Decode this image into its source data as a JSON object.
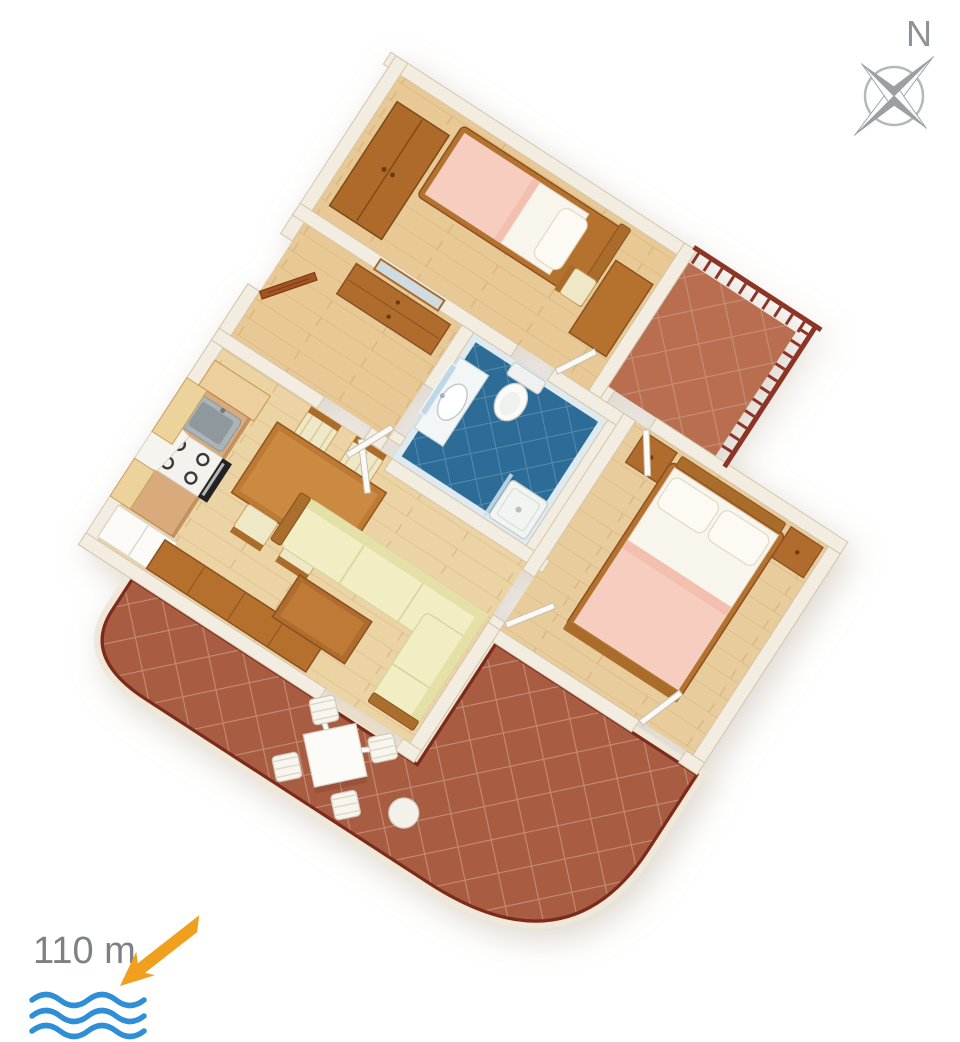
{
  "title": "apartment-3d-floor-plan",
  "compass": {
    "label": "N",
    "style": "four-point-star",
    "arms": [
      "NE",
      "SW",
      "NW",
      "SE"
    ]
  },
  "distance_to_sea": {
    "label": "110 m",
    "arrow_direction": "down-left",
    "wave_lines": 3
  },
  "rooms": [
    {
      "id": "single-bedroom",
      "name": "Bedroom with single bed"
    },
    {
      "id": "double-bedroom",
      "name": "Bedroom with double bed"
    },
    {
      "id": "bathroom",
      "name": "Bathroom"
    },
    {
      "id": "hallway",
      "name": "Entrance hallway"
    },
    {
      "id": "kitchen",
      "name": "Kitchen"
    },
    {
      "id": "living-dining",
      "name": "Living / dining room"
    },
    {
      "id": "balcony",
      "name": "Balcony with railing"
    },
    {
      "id": "terrace",
      "name": "Curved terrace"
    }
  ],
  "furniture": {
    "single_bedroom": [
      "wardrobe",
      "single-bed",
      "pillow",
      "pink-blanket",
      "desk",
      "chair"
    ],
    "double_bedroom": [
      "double-bed",
      "two-pillows",
      "pink-blanket",
      "nightstand-left",
      "nightstand-right"
    ],
    "bathroom": [
      "vanity-washbasin",
      "mirror",
      "toilet",
      "shower-tray"
    ],
    "hallway": [
      "entrance-door",
      "dresser",
      "wall-mirror"
    ],
    "kitchen": [
      "tall-cabinet",
      "upper-cabinets",
      "counter",
      "sink",
      "cooktop",
      "oven",
      "extractor-hood",
      "refrigerator"
    ],
    "living_dining": [
      "dining-table",
      "dining-chairs-x4",
      "sideboard",
      "corner-sofa",
      "coffee-table",
      "glass-terrace-doors"
    ],
    "terrace": [
      "square-table",
      "outdoor-chairs-x4",
      "stool"
    ],
    "balcony": [
      "wood-railing"
    ]
  },
  "palette": {
    "background": "#ffffff",
    "wall": "#f3ede1",
    "wall_edge": "#d3c5ab",
    "wood_floor": "#e8c995",
    "wood_floor_living": "#ecd3a4",
    "furniture_wood": "#b06c2c",
    "furniture_wood_dark": "#8a5120",
    "kitchen_cabinet": "#ecd29b",
    "bedding_white": "#f8f5ec",
    "blanket_pink": "#f7cdbf",
    "sofa_yellow": "#f0eec2",
    "bathroom_floor": "#2c6c96",
    "bathroom_tile_line": "#5e93b5",
    "terrace_tile": "#a85c41",
    "terrace_grout": "#c8947e",
    "terrace_rail": "#7c2b1b",
    "balcony_tile": "#b96e50",
    "railing_wood": "#8c3527",
    "compass_gray": "#9aa0a4",
    "text_gray": "#7d8184",
    "arrow_orange": "#f09f1f",
    "wave_blue": "#2e8ed6"
  }
}
